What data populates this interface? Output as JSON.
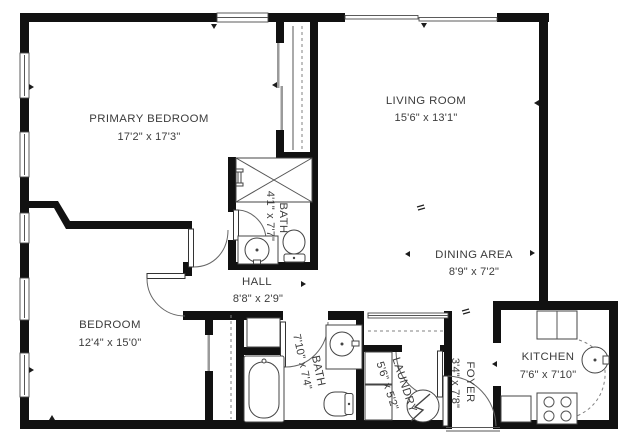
{
  "plan": {
    "title": "apartment-floor-plan",
    "colors": {
      "background": "#ffffff",
      "wall": "#111111",
      "text": "#3c3c3c"
    },
    "rooms": [
      {
        "name": "PRIMARY BEDROOM",
        "dims": "17'2\" x 17'3\""
      },
      {
        "name": "LIVING ROOM",
        "dims": "15'6\" x 13'1\""
      },
      {
        "name": "DINING AREA",
        "dims": "8'9\" x 7'2\""
      },
      {
        "name": "BATH",
        "dims": "4'1\" x 7'7\""
      },
      {
        "name": "HALL",
        "dims": "8'8\" x 2'9\""
      },
      {
        "name": "BEDROOM",
        "dims": "12'4\" x 15'0\""
      },
      {
        "name": "BATH",
        "dims": "7'10\" x 7'4\""
      },
      {
        "name": "LAUNDRY",
        "dims": "5'6\" x 5'2\""
      },
      {
        "name": "FOYER",
        "dims": "3'4\" x 7'8\""
      },
      {
        "name": "KITCHEN",
        "dims": "7'6\" x 7'10\""
      }
    ]
  }
}
